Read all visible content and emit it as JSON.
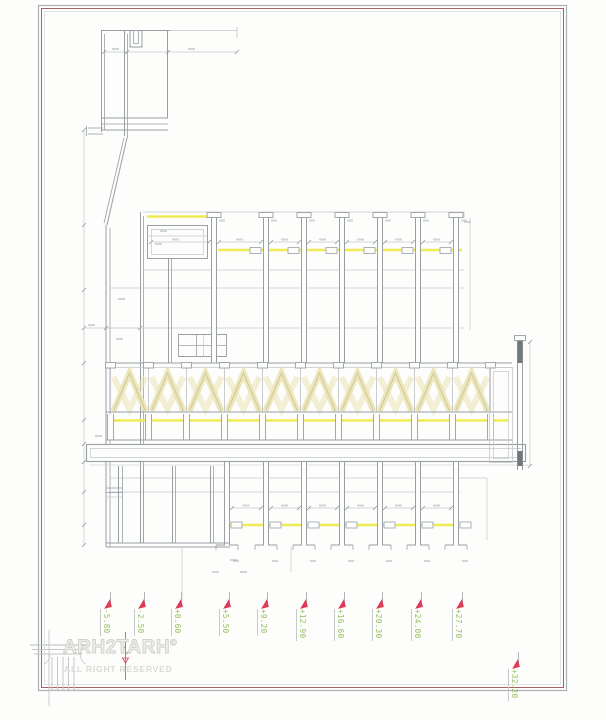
{
  "sheet": {
    "levels": [
      {
        "label": "-5.80",
        "x": 110,
        "y": 592
      },
      {
        "label": "-2.50",
        "x": 144,
        "y": 592
      },
      {
        "label": "+0.60",
        "x": 181,
        "y": 592
      },
      {
        "label": "+5.50",
        "x": 229,
        "y": 592
      },
      {
        "label": "+9.20",
        "x": 267,
        "y": 592
      },
      {
        "label": "+12.90",
        "x": 306,
        "y": 592
      },
      {
        "label": "+16.60",
        "x": 344,
        "y": 592
      },
      {
        "label": "+20.30",
        "x": 382,
        "y": 592
      },
      {
        "label": "+24.00",
        "x": 421,
        "y": 592
      },
      {
        "label": "+27.70",
        "x": 462,
        "y": 592
      },
      {
        "label": "+32.20",
        "x": 518,
        "y": 652
      }
    ]
  },
  "logo": {
    "brand": "ARH2TARH",
    "copyright_symbol": "©",
    "tagline": "ALL RIGHT RESERVED"
  },
  "colors": {
    "line_main": "#98a0a6",
    "line_thin": "#c3c7cb",
    "highlight_yellow": "#f0ec55",
    "truss_beige": "#ebe3b4",
    "truss_edge": "#c2bb95",
    "solid_fill": "#72777c",
    "level_green": "#93bd5a",
    "marker_red": "#e03a56",
    "frame_red": "#a86262",
    "frame_gray": "#aab0b4",
    "logo_gray": "#c4c8cc",
    "dim_blur": "#b6bac0"
  }
}
